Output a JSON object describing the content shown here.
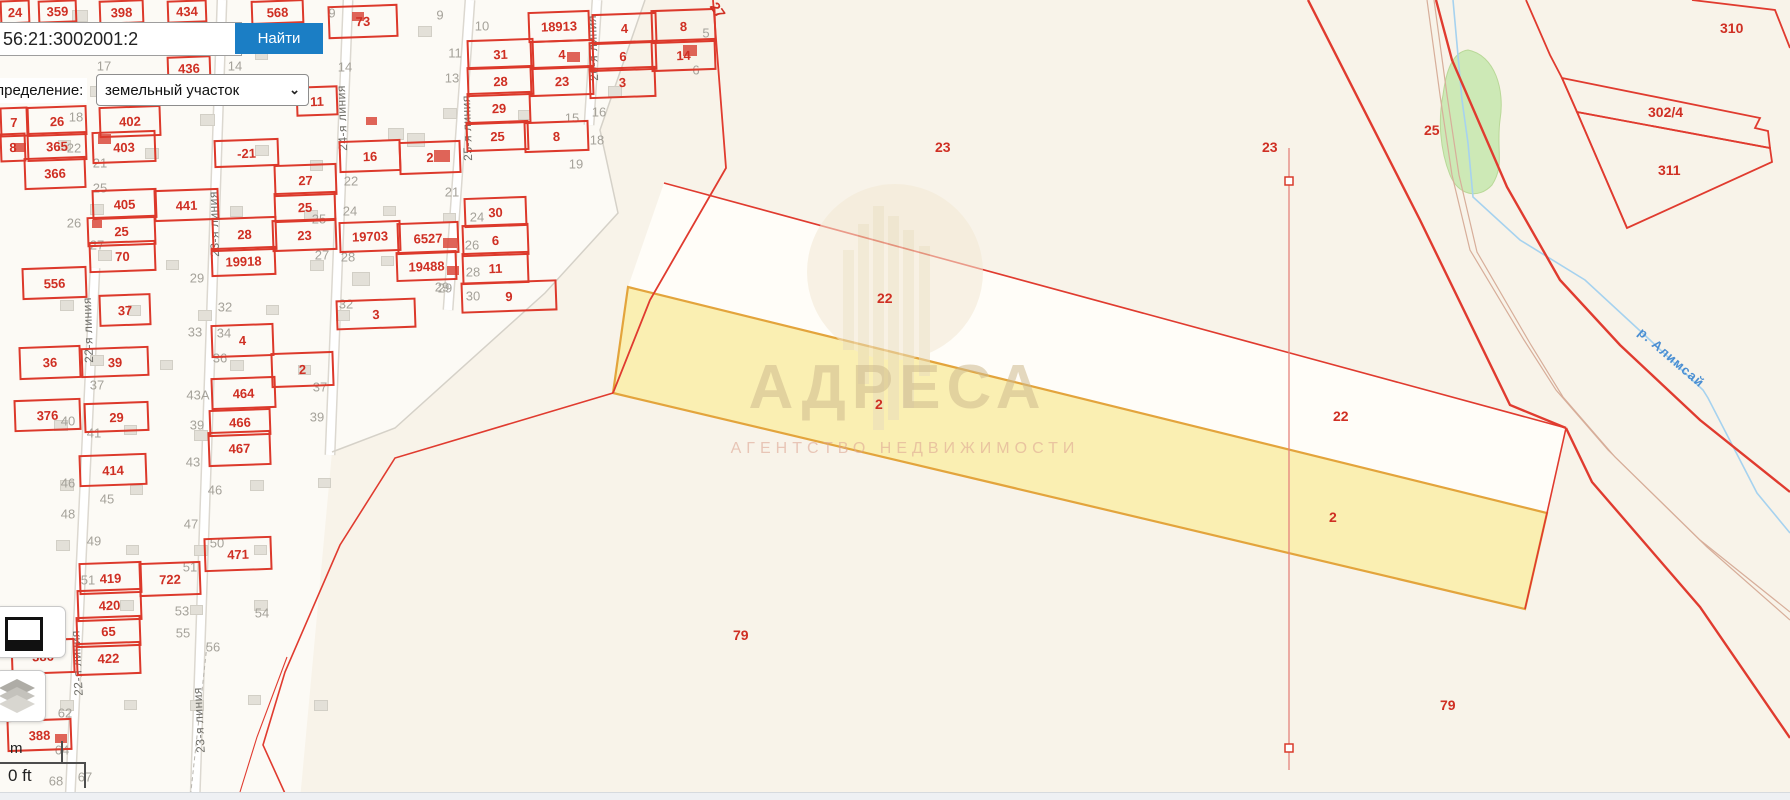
{
  "search": {
    "value": "56:21:3002001:2",
    "button_label": "Найти"
  },
  "filter": {
    "label": "пределение:",
    "value": "земельный участок",
    "chevron": "⌄"
  },
  "watermark": {
    "title": "АДРЕСА",
    "subtitle": "АГЕНТСТВО НЕДВИЖИМОСТИ"
  },
  "scalebar": {
    "m_label": "m",
    "ft_label": "0 ft"
  },
  "river": {
    "label": "р. Алимсай"
  },
  "colors": {
    "parcel_red": "#dc392b",
    "selected_fill": "#f9eeaa",
    "selected_border": "#e3a43c",
    "button_blue": "#1b7ec5",
    "river_blue": "#a6d2ef",
    "green_area": "#cde9b6"
  },
  "map": {
    "parcels": [
      {
        "t": "24",
        "x": 0,
        "y": 0,
        "w": 26,
        "h": 20
      },
      {
        "t": "359",
        "x": 38,
        "y": 0,
        "w": 35,
        "h": 19
      },
      {
        "t": "398",
        "x": 99,
        "y": 0,
        "w": 41,
        "h": 20
      },
      {
        "t": "434",
        "x": 167,
        "y": 0,
        "w": 36,
        "h": 19
      },
      {
        "t": "568",
        "x": 251,
        "y": 0,
        "w": 49,
        "h": 20
      },
      {
        "t": "73",
        "x": 328,
        "y": 5,
        "w": 66,
        "h": 29
      },
      {
        "t": "436",
        "x": 167,
        "y": 56,
        "w": 40,
        "h": 21
      },
      {
        "t": "11",
        "x": 296,
        "y": 86,
        "w": 38,
        "h": 26
      },
      {
        "t": "18913",
        "x": 528,
        "y": 11,
        "w": 58,
        "h": 27
      },
      {
        "t": "4",
        "x": 592,
        "y": 13,
        "w": 61,
        "h": 27
      },
      {
        "t": "8",
        "x": 651,
        "y": 9,
        "w": 61,
        "h": 30
      },
      {
        "t": "31",
        "x": 467,
        "y": 39,
        "w": 63,
        "h": 26
      },
      {
        "t": "4",
        "x": 530,
        "y": 40,
        "w": 60,
        "h": 25
      },
      {
        "t": "6",
        "x": 589,
        "y": 41,
        "w": 64,
        "h": 26
      },
      {
        "t": "14",
        "x": 651,
        "y": 39,
        "w": 61,
        "h": 28
      },
      {
        "t": "28",
        "x": 467,
        "y": 66,
        "w": 63,
        "h": 26
      },
      {
        "t": "23",
        "x": 530,
        "y": 66,
        "w": 60,
        "h": 26
      },
      {
        "t": "3",
        "x": 589,
        "y": 67,
        "w": 63,
        "h": 27
      },
      {
        "t": "29",
        "x": 467,
        "y": 92,
        "w": 60,
        "h": 28
      },
      {
        "t": "25",
        "x": 466,
        "y": 121,
        "w": 59,
        "h": 26
      },
      {
        "t": "8",
        "x": 524,
        "y": 121,
        "w": 61,
        "h": 27
      },
      {
        "t": "30",
        "x": 464,
        "y": 197,
        "w": 59,
        "h": 26
      },
      {
        "t": "6",
        "x": 462,
        "y": 224,
        "w": 63,
        "h": 28
      },
      {
        "t": "11",
        "x": 462,
        "y": 252,
        "w": 63,
        "h": 28
      },
      {
        "t": "9",
        "x": 461,
        "y": 281,
        "w": 92,
        "h": 27
      },
      {
        "t": "7",
        "x": 0,
        "y": 107,
        "w": 24,
        "h": 26
      },
      {
        "t": "26",
        "x": 27,
        "y": 106,
        "w": 56,
        "h": 26
      },
      {
        "t": "365",
        "x": 27,
        "y": 132,
        "w": 56,
        "h": 25
      },
      {
        "t": "8",
        "x": 0,
        "y": 133,
        "w": 22,
        "h": 25
      },
      {
        "t": "366",
        "x": 24,
        "y": 157,
        "w": 58,
        "h": 28
      },
      {
        "t": "402",
        "x": 99,
        "y": 106,
        "w": 58,
        "h": 27
      },
      {
        "t": "403",
        "x": 92,
        "y": 131,
        "w": 60,
        "h": 28
      },
      {
        "t": "-21",
        "x": 214,
        "y": 139,
        "w": 61,
        "h": 24
      },
      {
        "t": "405",
        "x": 92,
        "y": 189,
        "w": 61,
        "h": 26
      },
      {
        "t": "441",
        "x": 154,
        "y": 189,
        "w": 61,
        "h": 28
      },
      {
        "t": "25",
        "x": 87,
        "y": 216,
        "w": 65,
        "h": 26
      },
      {
        "t": "70",
        "x": 89,
        "y": 241,
        "w": 63,
        "h": 27
      },
      {
        "t": "27",
        "x": 274,
        "y": 164,
        "w": 59,
        "h": 28
      },
      {
        "t": "25",
        "x": 274,
        "y": 192,
        "w": 58,
        "h": 26
      },
      {
        "t": "28",
        "x": 212,
        "y": 217,
        "w": 61,
        "h": 30
      },
      {
        "t": "23",
        "x": 272,
        "y": 219,
        "w": 61,
        "h": 28
      },
      {
        "t": "19918",
        "x": 211,
        "y": 247,
        "w": 61,
        "h": 25
      },
      {
        "t": "556",
        "x": 22,
        "y": 267,
        "w": 61,
        "h": 28
      },
      {
        "t": "16",
        "x": 339,
        "y": 140,
        "w": 58,
        "h": 28
      },
      {
        "t": "2",
        "x": 399,
        "y": 141,
        "w": 58,
        "h": 29
      },
      {
        "t": "19703",
        "x": 339,
        "y": 221,
        "w": 58,
        "h": 27
      },
      {
        "t": "6527",
        "x": 397,
        "y": 222,
        "w": 58,
        "h": 28
      },
      {
        "t": "19488",
        "x": 396,
        "y": 251,
        "w": 57,
        "h": 26
      },
      {
        "t": "3",
        "x": 336,
        "y": 299,
        "w": 76,
        "h": 26
      },
      {
        "t": "37",
        "x": 99,
        "y": 294,
        "w": 48,
        "h": 28
      },
      {
        "t": "36",
        "x": 19,
        "y": 346,
        "w": 58,
        "h": 29
      },
      {
        "t": "39",
        "x": 81,
        "y": 347,
        "w": 64,
        "h": 26
      },
      {
        "t": "376",
        "x": 14,
        "y": 399,
        "w": 63,
        "h": 28
      },
      {
        "t": "29",
        "x": 84,
        "y": 402,
        "w": 61,
        "h": 26
      },
      {
        "t": "4",
        "x": 211,
        "y": 324,
        "w": 59,
        "h": 29
      },
      {
        "t": "2",
        "x": 271,
        "y": 352,
        "w": 59,
        "h": 31
      },
      {
        "t": "464",
        "x": 211,
        "y": 377,
        "w": 61,
        "h": 28
      },
      {
        "t": "466",
        "x": 209,
        "y": 409,
        "w": 58,
        "h": 23
      },
      {
        "t": "467",
        "x": 208,
        "y": 431,
        "w": 59,
        "h": 31
      },
      {
        "t": "414",
        "x": 79,
        "y": 454,
        "w": 64,
        "h": 28
      },
      {
        "t": "471",
        "x": 204,
        "y": 537,
        "w": 64,
        "h": 30
      },
      {
        "t": "419",
        "x": 79,
        "y": 562,
        "w": 59,
        "h": 28
      },
      {
        "t": "722",
        "x": 139,
        "y": 562,
        "w": 58,
        "h": 30
      },
      {
        "t": "420",
        "x": 77,
        "y": 589,
        "w": 61,
        "h": 28
      },
      {
        "t": "65",
        "x": 76,
        "y": 616,
        "w": 61,
        "h": 27
      },
      {
        "t": "386",
        "x": 11,
        "y": 639,
        "w": 60,
        "h": 31
      },
      {
        "t": "422",
        "x": 76,
        "y": 642,
        "w": 61,
        "h": 29
      },
      {
        "t": "388",
        "x": 7,
        "y": 719,
        "w": 61,
        "h": 28
      }
    ],
    "quarter_labels": [
      {
        "t": "23",
        "x": 935,
        "y": 139
      },
      {
        "t": "23",
        "x": 1262,
        "y": 139
      },
      {
        "t": "25",
        "x": 1424,
        "y": 122
      },
      {
        "t": "22",
        "x": 877,
        "y": 290
      },
      {
        "t": "22",
        "x": 1333,
        "y": 408
      },
      {
        "t": "2",
        "x": 875,
        "y": 396
      },
      {
        "t": "2",
        "x": 1329,
        "y": 509
      },
      {
        "t": "79",
        "x": 733,
        "y": 627
      },
      {
        "t": "79",
        "x": 1440,
        "y": 697
      },
      {
        "t": "310",
        "x": 1720,
        "y": 20
      },
      {
        "t": "302/4",
        "x": 1648,
        "y": 104
      },
      {
        "t": "311",
        "x": 1658,
        "y": 162
      },
      {
        "t": "27",
        "x": 710,
        "y": 2,
        "r": 55
      }
    ],
    "grey_numbers": [
      {
        "t": "9",
        "x": 332,
        "y": 13
      },
      {
        "t": "9",
        "x": 440,
        "y": 15
      },
      {
        "t": "10",
        "x": 482,
        "y": 26
      },
      {
        "t": "11",
        "x": 455,
        "y": 53
      },
      {
        "t": "13",
        "x": 452,
        "y": 78
      },
      {
        "t": "15",
        "x": 572,
        "y": 118
      },
      {
        "t": "16",
        "x": 599,
        "y": 112
      },
      {
        "t": "18",
        "x": 597,
        "y": 140
      },
      {
        "t": "19",
        "x": 576,
        "y": 164
      },
      {
        "t": "21",
        "x": 452,
        "y": 192
      },
      {
        "t": "24",
        "x": 477,
        "y": 217
      },
      {
        "t": "26",
        "x": 472,
        "y": 245
      },
      {
        "t": "28",
        "x": 473,
        "y": 272
      },
      {
        "t": "29",
        "x": 445,
        "y": 288
      },
      {
        "t": "30",
        "x": 473,
        "y": 296
      },
      {
        "t": "5",
        "x": 706,
        "y": 33
      },
      {
        "t": "6",
        "x": 696,
        "y": 70
      },
      {
        "t": "14",
        "x": 345,
        "y": 67
      },
      {
        "t": "22",
        "x": 351,
        "y": 181
      },
      {
        "t": "24",
        "x": 350,
        "y": 211
      },
      {
        "t": "25",
        "x": 319,
        "y": 219
      },
      {
        "t": "27",
        "x": 322,
        "y": 255
      },
      {
        "t": "28",
        "x": 348,
        "y": 257
      },
      {
        "t": "29",
        "x": 442,
        "y": 287
      },
      {
        "t": "32",
        "x": 346,
        "y": 304
      },
      {
        "t": "17",
        "x": 104,
        "y": 66
      },
      {
        "t": "14",
        "x": 235,
        "y": 66
      },
      {
        "t": "18",
        "x": 76,
        "y": 117
      },
      {
        "t": "22",
        "x": 74,
        "y": 148
      },
      {
        "t": "21",
        "x": 100,
        "y": 163
      },
      {
        "t": "25",
        "x": 100,
        "y": 188
      },
      {
        "t": "26",
        "x": 74,
        "y": 223
      },
      {
        "t": "27",
        "x": 97,
        "y": 245
      },
      {
        "t": "29",
        "x": 197,
        "y": 278
      },
      {
        "t": "32",
        "x": 225,
        "y": 307
      },
      {
        "t": "33",
        "x": 195,
        "y": 332
      },
      {
        "t": "34",
        "x": 224,
        "y": 333
      },
      {
        "t": "36",
        "x": 220,
        "y": 358
      },
      {
        "t": "37",
        "x": 97,
        "y": 385
      },
      {
        "t": "37",
        "x": 320,
        "y": 387
      },
      {
        "t": "40",
        "x": 68,
        "y": 421
      },
      {
        "t": "41",
        "x": 94,
        "y": 433
      },
      {
        "t": "43А",
        "x": 198,
        "y": 395
      },
      {
        "t": "39",
        "x": 317,
        "y": 417
      },
      {
        "t": "39",
        "x": 197,
        "y": 425
      },
      {
        "t": "43",
        "x": 193,
        "y": 462
      },
      {
        "t": "46",
        "x": 215,
        "y": 490
      },
      {
        "t": "45",
        "x": 107,
        "y": 499
      },
      {
        "t": "46",
        "x": 68,
        "y": 483
      },
      {
        "t": "48",
        "x": 68,
        "y": 514
      },
      {
        "t": "49",
        "x": 94,
        "y": 541
      },
      {
        "t": "47",
        "x": 191,
        "y": 524
      },
      {
        "t": "50",
        "x": 217,
        "y": 543
      },
      {
        "t": "51",
        "x": 88,
        "y": 580
      },
      {
        "t": "51",
        "x": 190,
        "y": 567
      },
      {
        "t": "53",
        "x": 182,
        "y": 611
      },
      {
        "t": "55",
        "x": 183,
        "y": 633
      },
      {
        "t": "54",
        "x": 262,
        "y": 613
      },
      {
        "t": "56",
        "x": 213,
        "y": 647
      },
      {
        "t": "58",
        "x": 58,
        "y": 646
      },
      {
        "t": "62",
        "x": 65,
        "y": 713
      },
      {
        "t": "64",
        "x": 62,
        "y": 750
      },
      {
        "t": "67",
        "x": 85,
        "y": 777
      },
      {
        "t": "68",
        "x": 56,
        "y": 781
      }
    ],
    "street_labels": [
      {
        "t": "22-я линия",
        "x": 88,
        "y": 330,
        "r": -92
      },
      {
        "t": "22-я линия",
        "x": 77,
        "y": 663,
        "r": -93
      },
      {
        "t": "23-я линия",
        "x": 214,
        "y": 224,
        "r": -92
      },
      {
        "t": "23-я линия",
        "x": 199,
        "y": 720,
        "r": -93
      },
      {
        "t": "24-я линия",
        "x": 342,
        "y": 118,
        "r": -92
      },
      {
        "t": "25-я линия",
        "x": 467,
        "y": 128,
        "r": -92
      },
      {
        "t": "26-я линия",
        "x": 593,
        "y": 48,
        "r": -92
      }
    ],
    "buildings": [
      [
        72,
        10,
        14,
        10
      ],
      [
        140,
        36,
        12,
        9
      ],
      [
        198,
        45,
        12,
        9
      ],
      [
        255,
        50,
        11,
        8
      ],
      [
        418,
        26,
        12,
        9
      ],
      [
        90,
        86,
        12,
        9
      ],
      [
        157,
        90,
        11,
        8
      ],
      [
        224,
        95,
        11,
        8
      ],
      [
        200,
        114,
        13,
        10
      ],
      [
        388,
        128,
        14,
        10
      ],
      [
        407,
        133,
        16,
        12
      ],
      [
        58,
        140,
        11,
        9
      ],
      [
        145,
        148,
        12,
        9
      ],
      [
        255,
        145,
        12,
        9
      ],
      [
        310,
        160,
        11,
        9
      ],
      [
        443,
        108,
        12,
        9
      ],
      [
        518,
        110,
        11,
        8
      ],
      [
        608,
        86,
        12,
        9
      ],
      [
        90,
        204,
        12,
        9
      ],
      [
        230,
        206,
        11,
        9
      ],
      [
        304,
        210,
        12,
        9
      ],
      [
        383,
        206,
        11,
        8
      ],
      [
        443,
        213,
        11,
        8
      ],
      [
        98,
        250,
        12,
        9
      ],
      [
        166,
        260,
        11,
        8
      ],
      [
        310,
        260,
        12,
        9
      ],
      [
        381,
        256,
        11,
        8
      ],
      [
        352,
        272,
        16,
        12
      ],
      [
        60,
        300,
        12,
        9
      ],
      [
        128,
        305,
        11,
        9
      ],
      [
        198,
        310,
        12,
        9
      ],
      [
        266,
        305,
        11,
        8
      ],
      [
        336,
        310,
        12,
        9
      ],
      [
        90,
        355,
        12,
        9
      ],
      [
        160,
        360,
        11,
        8
      ],
      [
        230,
        360,
        12,
        9
      ],
      [
        298,
        365,
        11,
        8
      ],
      [
        54,
        420,
        12,
        9
      ],
      [
        124,
        425,
        11,
        8
      ],
      [
        194,
        430,
        12,
        9
      ],
      [
        60,
        480,
        12,
        9
      ],
      [
        130,
        485,
        11,
        8
      ],
      [
        250,
        480,
        12,
        9
      ],
      [
        318,
        478,
        11,
        8
      ],
      [
        56,
        540,
        12,
        9
      ],
      [
        126,
        545,
        11,
        8
      ],
      [
        194,
        545,
        12,
        9
      ],
      [
        254,
        545,
        11,
        8
      ],
      [
        120,
        600,
        12,
        9
      ],
      [
        190,
        605,
        11,
        8
      ],
      [
        254,
        600,
        12,
        9
      ],
      [
        60,
        700,
        12,
        9
      ],
      [
        124,
        700,
        11,
        8
      ],
      [
        190,
        700,
        12,
        9
      ],
      [
        248,
        695,
        11,
        8
      ],
      [
        314,
        700,
        12,
        9
      ]
    ],
    "red_buildings": [
      [
        352,
        12,
        12,
        9
      ],
      [
        567,
        52,
        13,
        10
      ],
      [
        683,
        45,
        14,
        11
      ],
      [
        98,
        134,
        13,
        10
      ],
      [
        14,
        143,
        12,
        9
      ],
      [
        434,
        150,
        16,
        12
      ],
      [
        443,
        238,
        14,
        10
      ],
      [
        447,
        266,
        12,
        9
      ],
      [
        366,
        117,
        11,
        8
      ],
      [
        55,
        734,
        12,
        9
      ],
      [
        92,
        220,
        10,
        8
      ]
    ]
  }
}
